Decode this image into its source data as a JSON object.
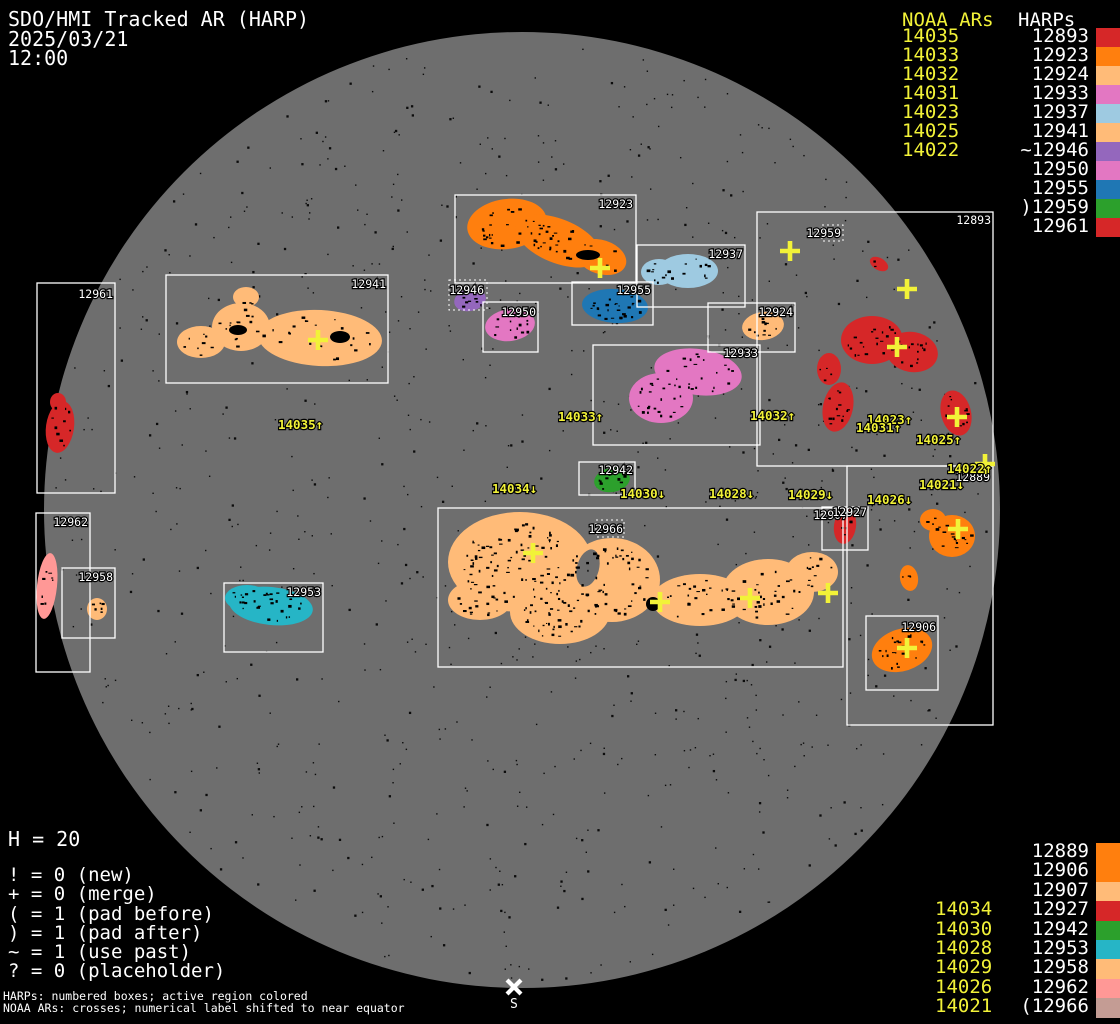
{
  "header": {
    "title": "SDO/HMI Tracked AR (HARP)",
    "date": "2025/03/21",
    "time": "12:00"
  },
  "legend_top": {
    "noaa_title": "NOAA ARs",
    "harp_title": "HARPs",
    "rows": [
      {
        "noaa": "14035",
        "harp": "12893",
        "color": "red"
      },
      {
        "noaa": "14033",
        "harp": "12923",
        "color": "orange"
      },
      {
        "noaa": "14032",
        "harp": "12924",
        "color": "peach"
      },
      {
        "noaa": "14031",
        "harp": "12933",
        "color": "orchid"
      },
      {
        "noaa": "14023",
        "harp": "12937",
        "color": "lightblue"
      },
      {
        "noaa": "14025",
        "harp": "12941",
        "color": "peach"
      },
      {
        "noaa": "14022",
        "harp": "~12946",
        "color": "purple"
      },
      {
        "noaa": "",
        "harp": "12950",
        "color": "orchid"
      },
      {
        "noaa": "",
        "harp": "12955",
        "color": "blue"
      },
      {
        "noaa": "",
        "harp": ")12959",
        "color": "green"
      },
      {
        "noaa": "",
        "harp": "12961",
        "color": "red"
      }
    ]
  },
  "legend_bottom_right": {
    "rows": [
      {
        "noaa": "",
        "harp": "12889",
        "color": "orange"
      },
      {
        "noaa": "",
        "harp": "12906",
        "color": "orange"
      },
      {
        "noaa": "",
        "harp": "12907",
        "color": "peach"
      },
      {
        "noaa": "14034",
        "harp": "12927",
        "color": "red"
      },
      {
        "noaa": "14030",
        "harp": "12942",
        "color": "green"
      },
      {
        "noaa": "14028",
        "harp": "12953",
        "color": "cyan"
      },
      {
        "noaa": "14029",
        "harp": "12958",
        "color": "peach"
      },
      {
        "noaa": "14026",
        "harp": "12962",
        "color": "lightpink"
      },
      {
        "noaa": "14021",
        "harp": "(12966",
        "color": "rosybrown"
      }
    ]
  },
  "legend_bottom_left": {
    "h_count": "H = 20",
    "symbols": "! = 0 (new)\n+ = 0 (merge)\n( = 1 (pad before)\n) = 1 (pad after)\n~ = 1 (use past)\n? = 0 (placeholder)",
    "footnote1": "HARPs: numbered boxes; active region colored",
    "footnote2": "NOAA ARs: crosses; numerical label shifted to near equator"
  },
  "chart_data": {
    "type": "solar-tracked-active-region-map",
    "title": "SDO/HMI Tracked AR (HARP)",
    "date": "2025/03/21",
    "time": "12:00",
    "harp_count": 20,
    "disk": {
      "cx": 522,
      "cy": 510,
      "r": 478,
      "color": "#6e6e6e",
      "speckles": 950
    },
    "palette": {
      "red": "#d62728",
      "orange": "#ff7f0e",
      "peach": "#ffbb78",
      "orchid": "#e377c2",
      "lightblue": "#9ecae1",
      "purple": "#9467bd",
      "blue": "#1f77b4",
      "green": "#2ca02c",
      "cyan": "#26b5c6",
      "lightpink": "#ff9896",
      "rosybrown": "#c49c94",
      "yellow": "#f2f238"
    },
    "regions": [
      {
        "harp": "12893",
        "color": "red",
        "box": [
          757,
          212,
          236,
          254
        ],
        "label": [
          991,
          224
        ],
        "blobs": [
          [
            872,
            340,
            31,
            24,
            0
          ],
          [
            912,
            352,
            26,
            20,
            10
          ],
          [
            829,
            369,
            12,
            16,
            0
          ],
          [
            838,
            407,
            15,
            25,
            12
          ],
          [
            879,
            264,
            10,
            6,
            30
          ],
          [
            956,
            413,
            15,
            23,
            -15
          ]
        ],
        "spots": 70
      },
      {
        "harp": "12923",
        "color": "orange",
        "box": [
          455,
          195,
          181,
          88
        ],
        "label": [
          633,
          208
        ],
        "blobs": [
          [
            507,
            224,
            40,
            25,
            -8
          ],
          [
            558,
            241,
            45,
            22,
            22
          ],
          [
            601,
            257,
            26,
            17,
            18
          ]
        ],
        "spots": 55
      },
      {
        "harp": "12937",
        "color": "lightblue",
        "box": [
          637,
          245,
          108,
          62
        ],
        "label": [
          743,
          258
        ],
        "blobs": [
          [
            688,
            271,
            30,
            17,
            0
          ],
          [
            659,
            272,
            18,
            13,
            0
          ]
        ],
        "spots": 18
      },
      {
        "harp": "12946",
        "color": "purple",
        "box": [
          449,
          280,
          38,
          30
        ],
        "box_style": "dotted",
        "label": [
          484,
          294
        ],
        "blobs": [
          [
            470,
            300,
            16,
            11,
            -12
          ]
        ],
        "spots": 7
      },
      {
        "harp": "12950",
        "color": "orchid",
        "box": [
          483,
          302,
          55,
          50
        ],
        "label": [
          536,
          316
        ],
        "blobs": [
          [
            510,
            325,
            25,
            16,
            -8
          ]
        ],
        "spots": 14
      },
      {
        "harp": "12955",
        "color": "blue",
        "box": [
          572,
          282,
          81,
          43
        ],
        "label": [
          651,
          294
        ],
        "blobs": [
          [
            615,
            306,
            33,
            17,
            4
          ]
        ],
        "spots": 26
      },
      {
        "harp": "12941",
        "color": "peach",
        "box": [
          166,
          275,
          222,
          108
        ],
        "label": [
          386,
          288
        ],
        "blobs": [
          [
            246,
            297,
            13,
            10,
            0
          ],
          [
            241,
            327,
            29,
            24,
            0
          ],
          [
            201,
            342,
            24,
            16,
            0
          ],
          [
            320,
            338,
            62,
            28,
            3
          ]
        ],
        "spots": 50
      },
      {
        "harp": "12961",
        "color": "red",
        "box": [
          37,
          283,
          78,
          210
        ],
        "label": [
          113,
          298
        ],
        "blobs": [
          [
            60,
            427,
            14,
            26,
            8
          ],
          [
            58,
            402,
            8,
            9,
            0
          ]
        ],
        "spots": 10
      },
      {
        "harp": "12962",
        "color": "lightpink",
        "box": [
          36,
          513,
          54,
          159
        ],
        "label": [
          88,
          526
        ],
        "blobs": [
          [
            47,
            586,
            10,
            33,
            6
          ]
        ],
        "spots": 8
      },
      {
        "harp": "12958",
        "color": "peach",
        "box": [
          62,
          568,
          53,
          70
        ],
        "label": [
          113,
          581
        ],
        "blobs": [
          [
            97,
            609,
            10,
            11,
            0
          ]
        ],
        "spots": 6
      },
      {
        "harp": "12953",
        "color": "cyan",
        "box": [
          224,
          583,
          99,
          69
        ],
        "label": [
          321,
          596
        ],
        "blobs": [
          [
            271,
            606,
            42,
            19,
            6
          ],
          [
            247,
            598,
            22,
            13,
            0
          ]
        ],
        "spots": 32
      },
      {
        "harp": "12924",
        "color": "peach",
        "box": [
          708,
          303,
          87,
          49
        ],
        "label": [
          793,
          316
        ],
        "blobs": [
          [
            763,
            326,
            21,
            14,
            -8
          ]
        ],
        "spots": 12
      },
      {
        "harp": "12933",
        "color": "orchid",
        "box": [
          593,
          345,
          167,
          100
        ],
        "label": [
          758,
          357
        ],
        "blobs": [
          [
            698,
            372,
            44,
            23,
            8
          ],
          [
            661,
            398,
            32,
            25,
            0
          ]
        ],
        "spots": 45
      },
      {
        "harp": "12942",
        "color": "green",
        "box": [
          579,
          462,
          56,
          33
        ],
        "label": [
          633,
          474
        ],
        "blobs": [
          [
            612,
            480,
            18,
            12,
            -10
          ]
        ],
        "spots": 9
      },
      {
        "harp": "12959",
        "color": "green",
        "box": null,
        "label": [
          841,
          237
        ],
        "label_box": [
          822,
          225,
          21,
          16
        ],
        "blobs": [],
        "spots": 0
      },
      {
        "harp": "12966",
        "color": "peach",
        "box": [
          438,
          508,
          405,
          159
        ],
        "label": [
          623,
          533
        ],
        "label_box": [
          596,
          520,
          28,
          17
        ],
        "blobs": [
          [
            520,
            562,
            72,
            50,
            0
          ],
          [
            480,
            600,
            32,
            20,
            0
          ],
          [
            560,
            612,
            50,
            32,
            0
          ],
          [
            612,
            580,
            48,
            42,
            0
          ],
          [
            700,
            600,
            48,
            26,
            0
          ],
          [
            768,
            592,
            46,
            33,
            0
          ],
          [
            812,
            572,
            26,
            20,
            0
          ],
          [
            810,
            586,
            5,
            4,
            0
          ]
        ],
        "holes": [
          [
            588,
            568,
            11,
            19,
            15
          ]
        ],
        "spots": 270
      },
      {
        "harp": "12907",
        "color": "red",
        "box": [
          822,
          507,
          46,
          43
        ],
        "label": [
          848,
          519
        ],
        "blobs": [
          [
            845,
            526,
            11,
            18,
            8
          ]
        ],
        "spots": 9
      },
      {
        "harp": "12927",
        "color": "red",
        "box": null,
        "label": [
          867,
          516
        ],
        "blobs": [],
        "spots": 0
      },
      {
        "harp": "12889",
        "color": "orange",
        "box": [
          847,
          466,
          146,
          259
        ],
        "label": [
          990,
          481
        ],
        "blobs": [
          [
            952,
            536,
            23,
            21,
            0
          ],
          [
            933,
            520,
            13,
            11,
            0
          ],
          [
            909,
            578,
            9,
            13,
            -10
          ]
        ],
        "spots": 22
      },
      {
        "harp": "12906",
        "color": "orange",
        "box": [
          866,
          616,
          72,
          74
        ],
        "label": [
          936,
          631
        ],
        "blobs": [
          [
            902,
            650,
            31,
            21,
            -18
          ]
        ],
        "spots": 24
      }
    ],
    "black_marks": [
      [
        653,
        604,
        7,
        7
      ],
      [
        340,
        337,
        10,
        6
      ],
      [
        588,
        255,
        12,
        5
      ],
      [
        238,
        330,
        9,
        5
      ]
    ],
    "crosses": [
      [
        600,
        268
      ],
      [
        318,
        340
      ],
      [
        790,
        251
      ],
      [
        907,
        289
      ],
      [
        897,
        347
      ],
      [
        957,
        417
      ],
      [
        985,
        464
      ],
      [
        533,
        553
      ],
      [
        660,
        602
      ],
      [
        750,
        598
      ],
      [
        828,
        593
      ],
      [
        958,
        529
      ],
      [
        907,
        648
      ]
    ],
    "noaa_labels": [
      {
        "text": "14035↑",
        "x": 278,
        "y": 429
      },
      {
        "text": "14033↑",
        "x": 558,
        "y": 421
      },
      {
        "text": "14032↑",
        "x": 750,
        "y": 420
      },
      {
        "text": "14023↑",
        "x": 867,
        "y": 424
      },
      {
        "text": "14031↑",
        "x": 856,
        "y": 432
      },
      {
        "text": "14025↑",
        "x": 916,
        "y": 444
      },
      {
        "text": "14022↑",
        "x": 947,
        "y": 473
      },
      {
        "text": "14034↓",
        "x": 492,
        "y": 493
      },
      {
        "text": "14030↓",
        "x": 620,
        "y": 498
      },
      {
        "text": "14028↓",
        "x": 709,
        "y": 498
      },
      {
        "text": "14029↓",
        "x": 788,
        "y": 499
      },
      {
        "text": "14026↓",
        "x": 867,
        "y": 504
      },
      {
        "text": "14021↓",
        "x": 919,
        "y": 489
      }
    ],
    "south_marker": {
      "label": "S",
      "x": 514,
      "y": 987
    }
  }
}
